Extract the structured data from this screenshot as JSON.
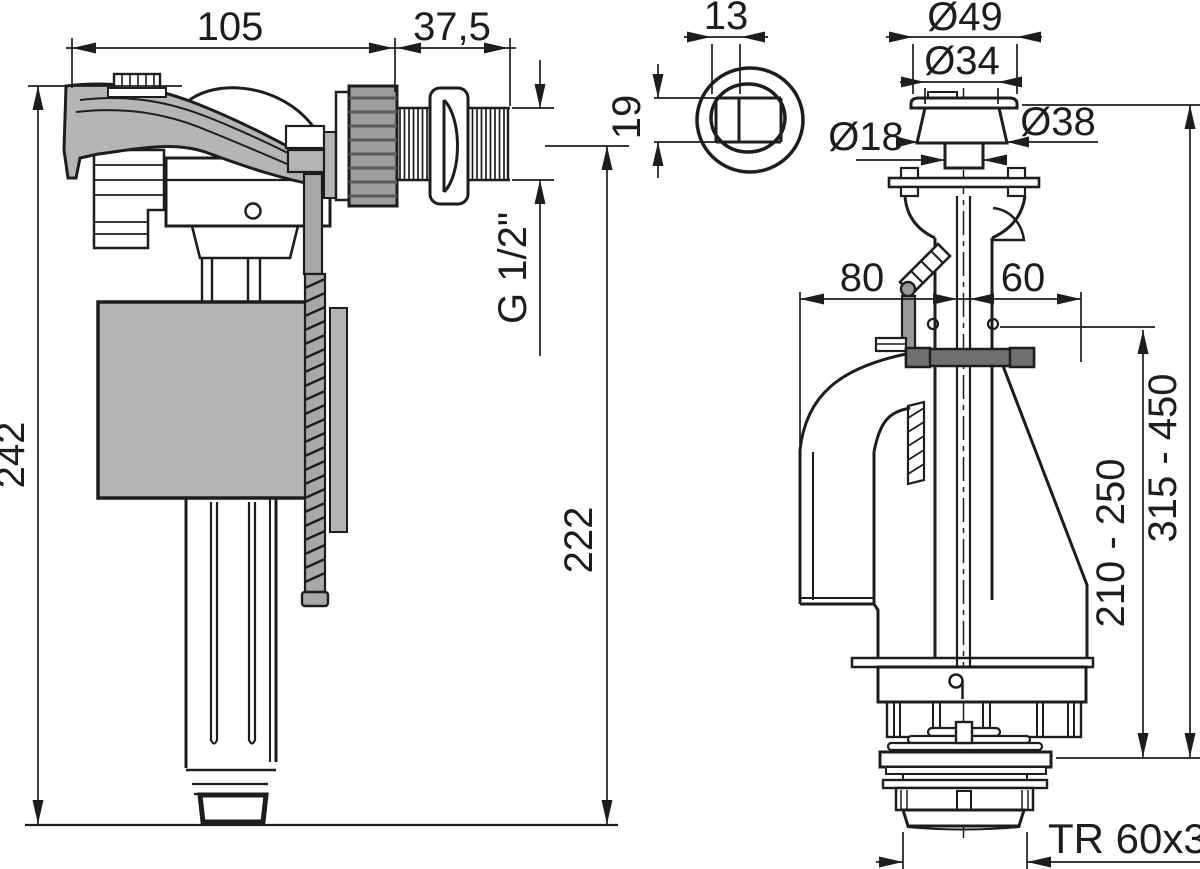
{
  "drawing": {
    "background": "#ffffff",
    "colors": {
      "line": "#1d1d1d",
      "part_gray": "#b5b5b5",
      "nut_gray": "#9c9c9c",
      "rod_gray": "#a8a8a8",
      "clamp_gray": "#707070",
      "bracket_gray": "#9a9a9a"
    },
    "fill_valve_view": {
      "dims": {
        "body_width": "105",
        "thread_length": "37,5",
        "total_height": "242",
        "axis_height": "222",
        "thread_size": "G 1/2\""
      }
    },
    "flush_valve_view": {
      "dims": {
        "button_small_width": "13",
        "button_window_height": "19",
        "cap_diameter": "Ø49",
        "body_diameter": "Ø34",
        "stem_diameter": "Ø18",
        "bezel_diameter": "Ø38",
        "offset_left": "80",
        "offset_right": "60",
        "inner_range": "210 - 250",
        "outer_range": "315 - 450",
        "base_thread": "TR 60x3"
      }
    }
  }
}
